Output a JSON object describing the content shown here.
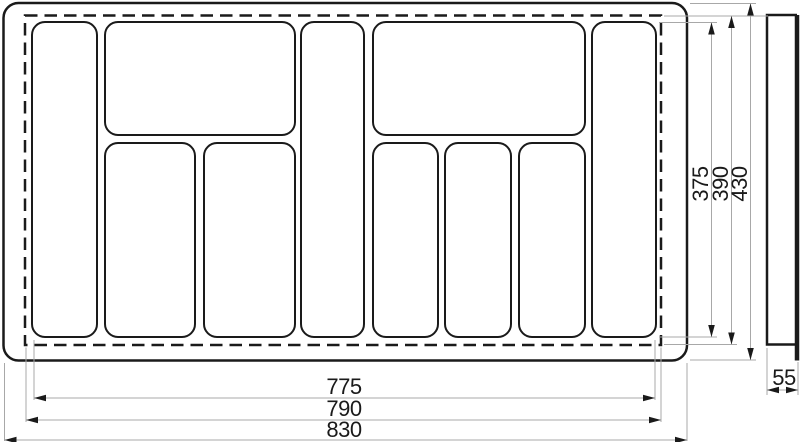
{
  "drawing": {
    "kind": "technical-dimension-drawing",
    "subject": "cutlery-tray-insert",
    "colors": {
      "background": "#ffffff",
      "outline": "#1a1a1a",
      "dimension_line": "#a8a8a8",
      "arrowhead": "#1a1a1a",
      "label": "#1a1a1a"
    },
    "top_view": {
      "compartment_count": 10
    },
    "dimensions": {
      "right_vertical": [
        "375",
        "390",
        "430"
      ],
      "bottom_horizontal": [
        "775",
        "790",
        "830"
      ],
      "side_view": [
        "55"
      ]
    }
  }
}
